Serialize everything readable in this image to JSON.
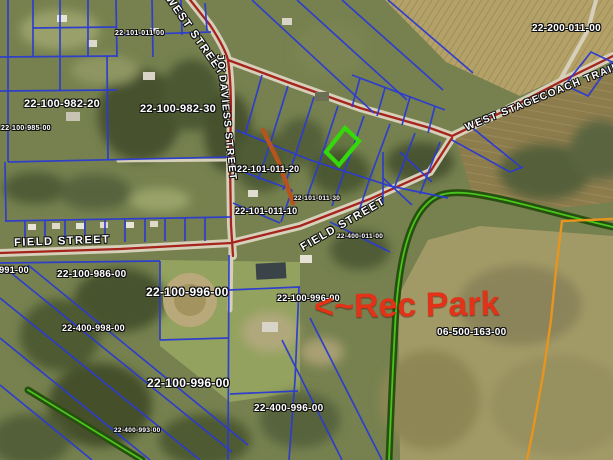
{
  "map": {
    "annotation": {
      "text": "<~Rec Park",
      "x": 314,
      "y": 290,
      "size": 34,
      "rotation": -1
    },
    "street_labels": [
      {
        "id": "west-street",
        "text": "WEST STREET",
        "x": 172,
        "y": -6,
        "size": 11,
        "rotation": 55
      },
      {
        "id": "jo-daviess-street",
        "text": "JO DAVIESS STREET",
        "x": 224,
        "y": 54,
        "size": 10,
        "rotation": 84
      },
      {
        "id": "west-stagecoach-trail",
        "text": "WEST STAGECOACH TRAIL",
        "x": 464,
        "y": 124,
        "size": 10,
        "rotation": -22
      },
      {
        "id": "field-street-west",
        "text": "FIELD STREET",
        "x": 14,
        "y": 238,
        "size": 11,
        "rotation": -2
      },
      {
        "id": "field-street-diagonal",
        "text": "FIELD STREET",
        "x": 299,
        "y": 244,
        "size": 11,
        "rotation": -30
      }
    ],
    "parcel_labels": [
      {
        "text": "22-101-011-00",
        "x": 115,
        "y": 30,
        "size": 7
      },
      {
        "text": "22-100-982-20",
        "x": 24,
        "y": 99,
        "size": 11
      },
      {
        "text": "22-100-982-30",
        "x": 140,
        "y": 104,
        "size": 11
      },
      {
        "text": "22-100-985-00",
        "x": 1,
        "y": 125,
        "size": 7
      },
      {
        "text": "22-101-011-20",
        "x": 237,
        "y": 165,
        "size": 9
      },
      {
        "text": "22-101-011-10",
        "x": 235,
        "y": 207,
        "size": 9
      },
      {
        "text": "22-101-011-30",
        "x": 294,
        "y": 196,
        "size": 6.5
      },
      {
        "text": "22-200-011-00",
        "x": 532,
        "y": 24,
        "size": 10
      },
      {
        "text": "22-400-011-00",
        "x": 337,
        "y": 234,
        "size": 6.5
      },
      {
        "text": "22-400-991-00",
        "x": -34,
        "y": 266,
        "size": 9
      },
      {
        "text": "22-100-986-00",
        "x": 57,
        "y": 270,
        "size": 10
      },
      {
        "text": "22-100-996-00",
        "x": 146,
        "y": 286,
        "size": 12
      },
      {
        "text": "22-100-996-00",
        "x": 277,
        "y": 294,
        "size": 9
      },
      {
        "text": "06-500-163-00",
        "x": 437,
        "y": 328,
        "size": 10
      },
      {
        "text": "22-400-998-00",
        "x": 62,
        "y": 324,
        "size": 9
      },
      {
        "text": "22-100-996-00",
        "x": 147,
        "y": 377,
        "size": 12
      },
      {
        "text": "22-400-996-00",
        "x": 254,
        "y": 404,
        "size": 10
      },
      {
        "text": "22-400-993-00",
        "x": 114,
        "y": 428,
        "size": 6.5
      }
    ],
    "colors": {
      "parcel_line": "#2b3bd0",
      "road_red": "#a5241c",
      "highlight_green": "#35d90b",
      "creek_dark": "#27500f",
      "creek_bright": "#49c41d",
      "orange_marker": "#b5541c",
      "orange_boundary": "#e8951d",
      "annotation_red": "#e23218",
      "label_white": "#ffffff"
    }
  }
}
